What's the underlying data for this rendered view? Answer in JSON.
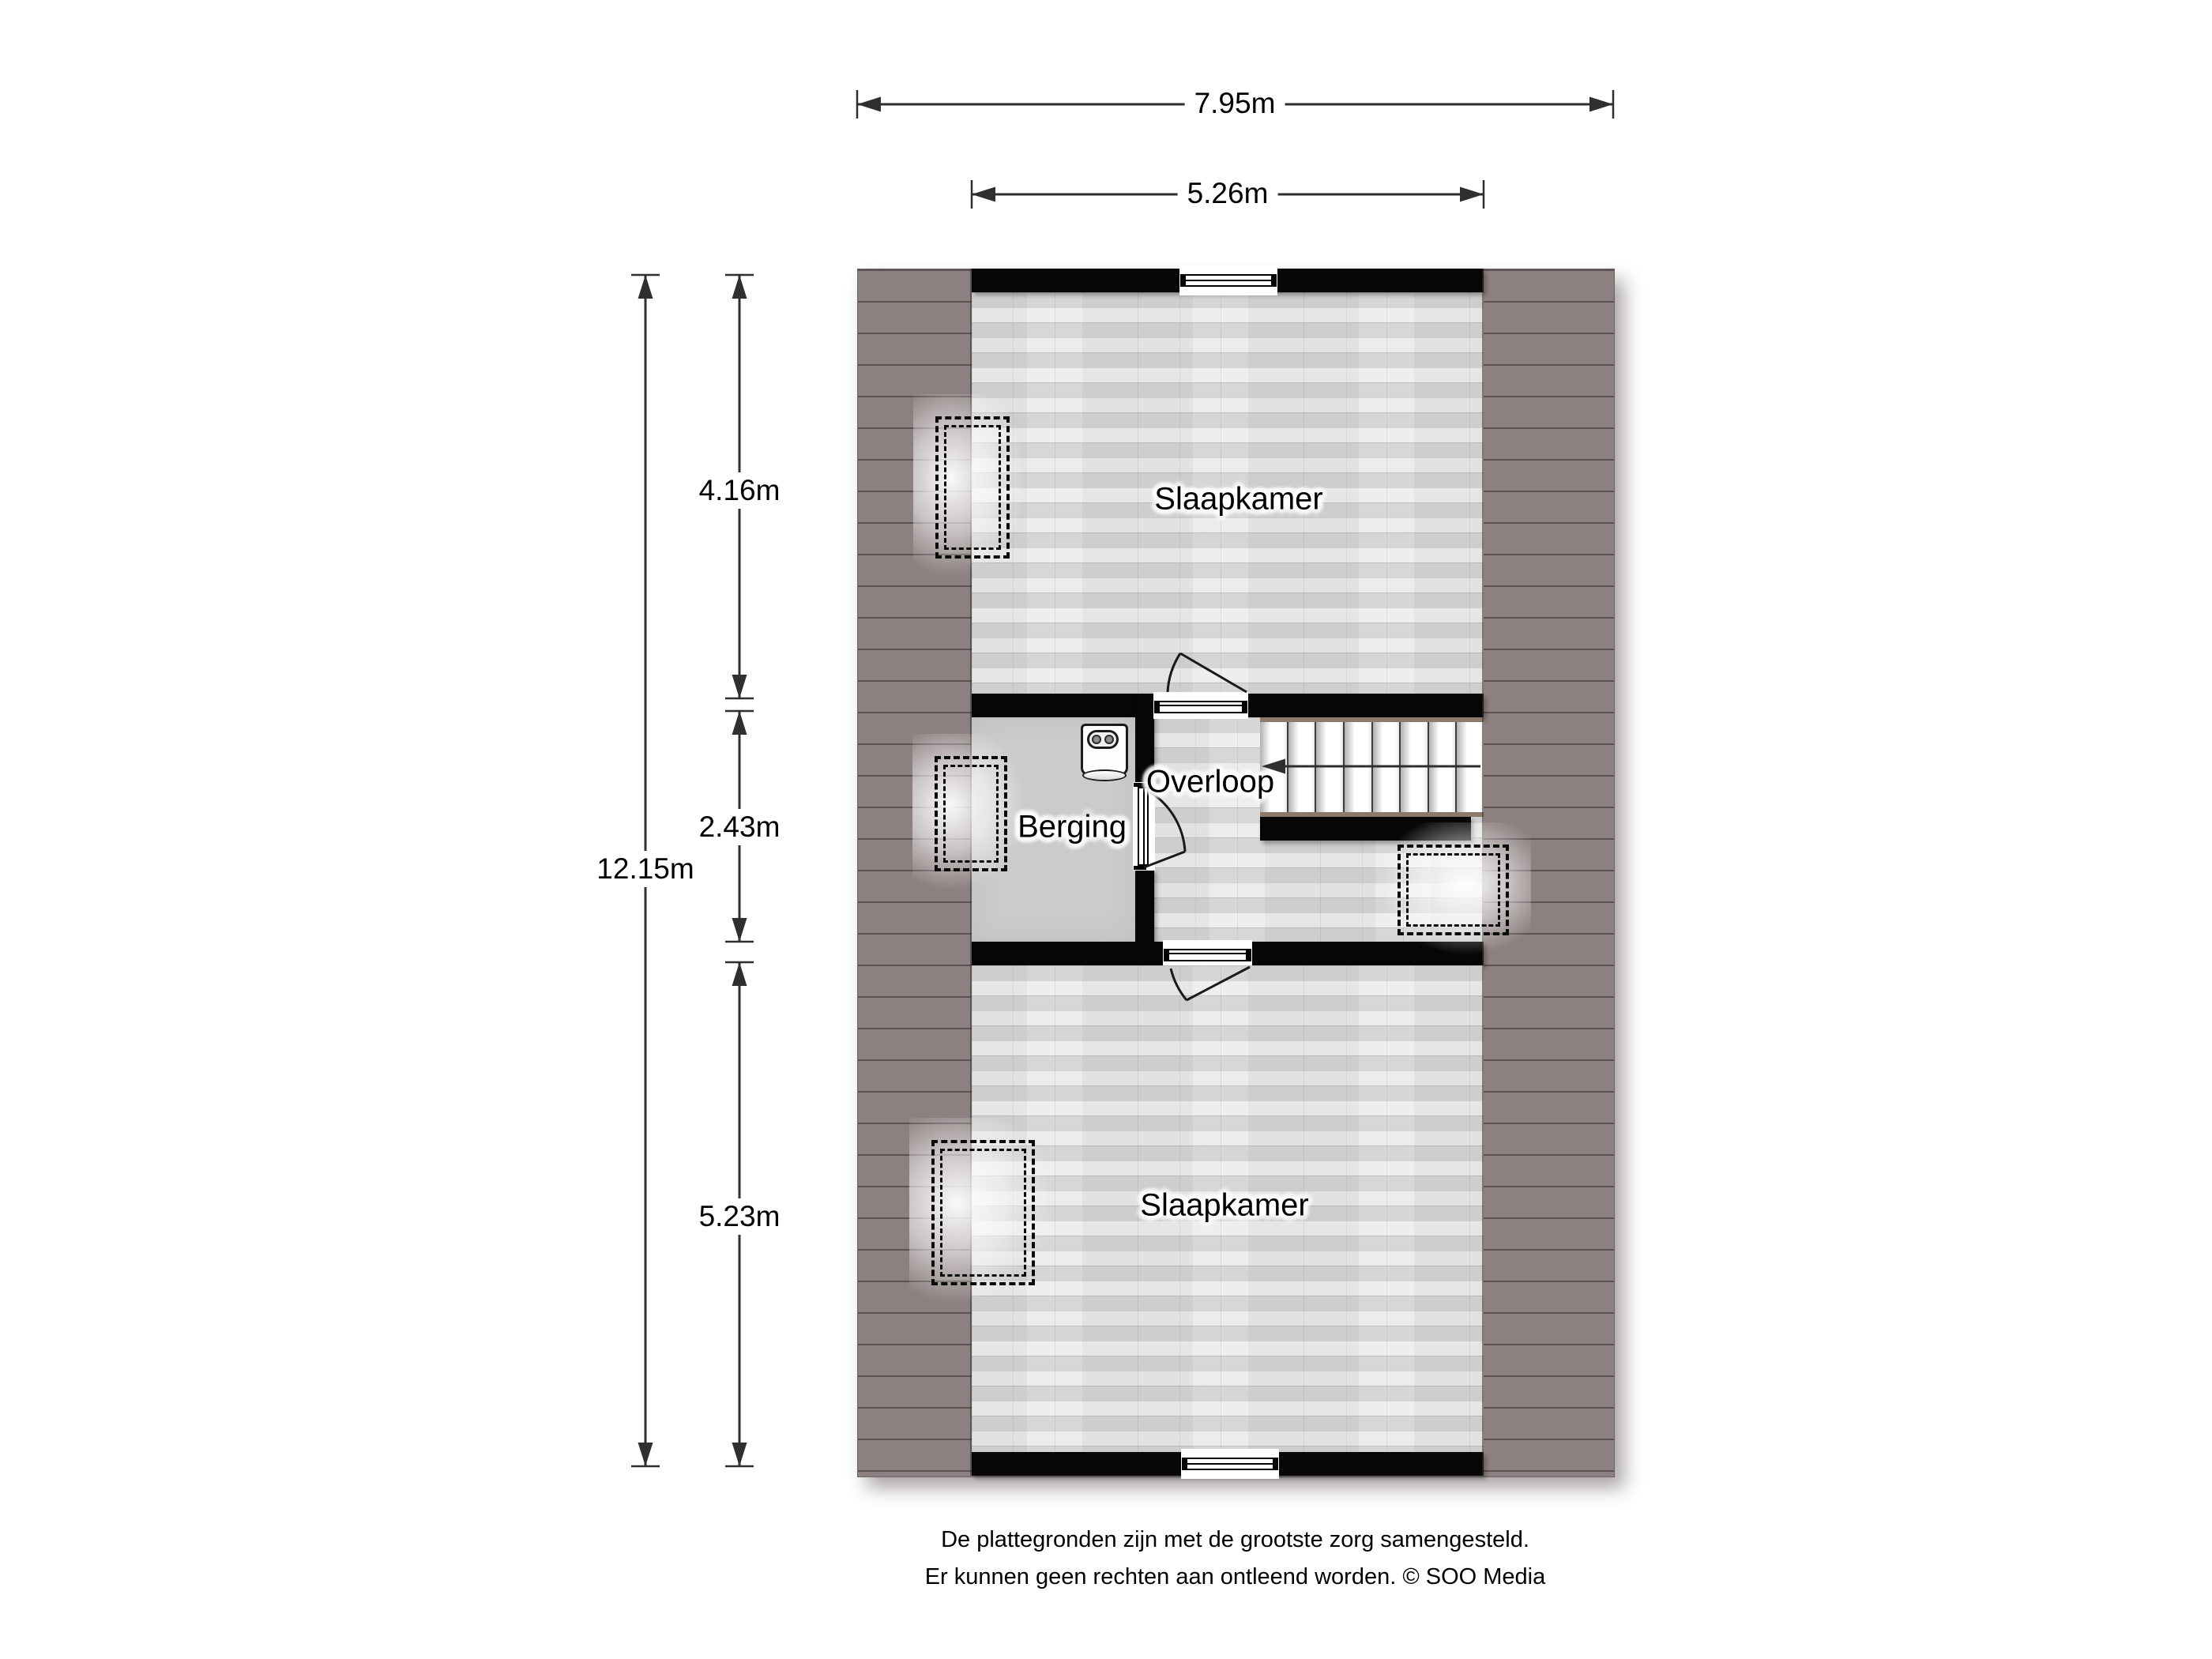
{
  "plan": {
    "rooms": [
      {
        "label": "Slaapkamer"
      },
      {
        "label": "Berging"
      },
      {
        "label": "Overloop"
      },
      {
        "label": "Slaapkamer"
      }
    ],
    "dimensions": {
      "total_width": "7.95m",
      "inner_width": "5.26m",
      "total_height": "12.15m",
      "top_section_height": "4.16m",
      "middle_section_height": "2.43m",
      "bottom_section_height": "5.23m"
    },
    "stairs": {
      "treads": 8,
      "direction": "left"
    }
  },
  "footer": {
    "line1": "De plattegronden zijn met de grootste zorg samengesteld.",
    "line2": "Er kunnen geen rechten aan ontleend worden. © SOO Media"
  },
  "colors": {
    "page_bg": "#ffffff",
    "roof": "#8d8080",
    "roof_line": "#5d5353",
    "wall": "#060606",
    "wood_floor": "#e6e6e6",
    "berging_floor": "#cbcbcb",
    "stair_edge": "#8c7a68",
    "dim_line": "#2f2f2f",
    "text": "#000000"
  }
}
